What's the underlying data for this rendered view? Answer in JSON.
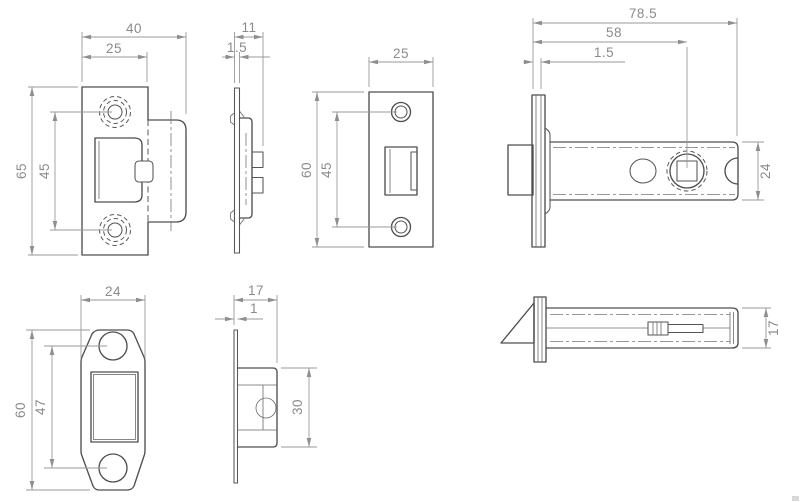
{
  "drawing": {
    "background_color": "#ffffff",
    "line_color": "#4f4f4f",
    "dimension_color": "#8b8b8b",
    "views": {
      "keep_front": {
        "overall_width": "40",
        "plate_width": "25",
        "plate_height": "65",
        "hole_spacing": "45"
      },
      "keep_side": {
        "overall_depth": "11",
        "plate_thickness": "1.5"
      },
      "faceplate_front": {
        "plate_width": "25",
        "plate_height": "60",
        "hole_spacing": "45"
      },
      "case_side": {
        "overall_length": "78.5",
        "backset": "58",
        "faceplate_thickness": "1.5",
        "case_height": "24"
      },
      "dustbox_front": {
        "plate_width": "24",
        "plate_height": "60",
        "hole_spacing": "47"
      },
      "dustbox_side": {
        "overall_depth": "17",
        "plate_thickness": "1",
        "box_height": "30"
      },
      "case_top": {
        "case_width": "17"
      }
    }
  }
}
